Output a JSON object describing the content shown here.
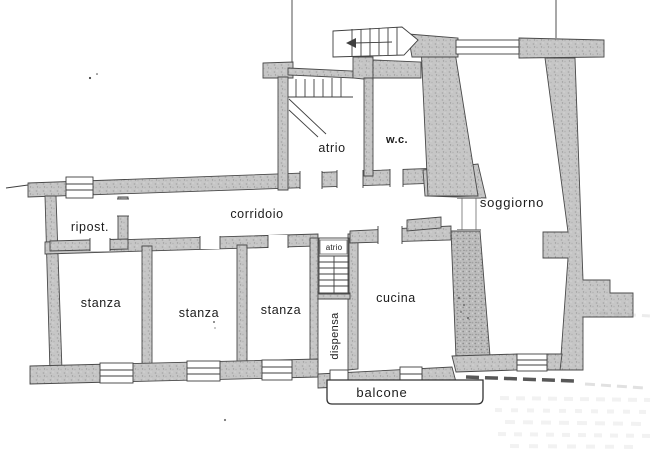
{
  "plan": {
    "rooms": {
      "ripostiglio": {
        "label": "ripost."
      },
      "corridoio": {
        "label": "corridoio"
      },
      "atrio": {
        "label": "atrio"
      },
      "wc": {
        "label": "w.c."
      },
      "soggiorno": {
        "label": "soggiorno"
      },
      "stanza_1": {
        "label": "stanza"
      },
      "stanza_2": {
        "label": "stanza"
      },
      "stanza_3": {
        "label": "stanza"
      },
      "atrio_small": {
        "label": "atrio"
      },
      "cucina": {
        "label": "cucina"
      },
      "dispensa": {
        "label": "dispensa"
      },
      "balcone": {
        "label": "balcone"
      }
    },
    "colors": {
      "background": "#ffffff",
      "wall_fill": "#c6c6c6",
      "wall_speckle": "#9c9c9c",
      "line": "#3f3f3f",
      "text": "#1c1c1c"
    }
  }
}
